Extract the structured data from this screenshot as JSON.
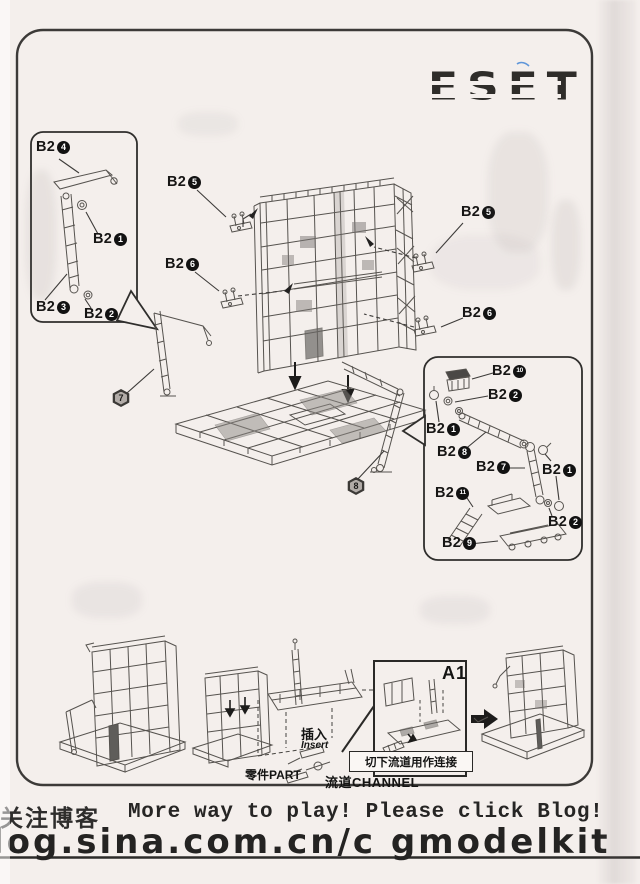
{
  "logo": "ESET",
  "part_labels": [
    {
      "text": "B2",
      "num": "4",
      "x": 36,
      "y": 139
    },
    {
      "text": "B2",
      "num": "1",
      "x": 93,
      "y": 231
    },
    {
      "text": "B2",
      "num": "3",
      "x": 36,
      "y": 299
    },
    {
      "text": "B2",
      "num": "2",
      "x": 84,
      "y": 306
    },
    {
      "text": "B2",
      "num": "5",
      "x": 167,
      "y": 174
    },
    {
      "text": "B2",
      "num": "6",
      "x": 165,
      "y": 256
    },
    {
      "text": "B2",
      "num": "5",
      "x": 461,
      "y": 204
    },
    {
      "text": "B2",
      "num": "6",
      "x": 462,
      "y": 305
    },
    {
      "text": "B2",
      "num": "10",
      "x": 492,
      "y": 363
    },
    {
      "text": "B2",
      "num": "2",
      "x": 488,
      "y": 387
    },
    {
      "text": "B2",
      "num": "1",
      "x": 426,
      "y": 421
    },
    {
      "text": "B2",
      "num": "8",
      "x": 437,
      "y": 444
    },
    {
      "text": "B2",
      "num": "7",
      "x": 476,
      "y": 459
    },
    {
      "text": "B2",
      "num": "1",
      "x": 542,
      "y": 462
    },
    {
      "text": "B2",
      "num": "11",
      "x": 435,
      "y": 485
    },
    {
      "text": "B2",
      "num": "2",
      "x": 548,
      "y": 514
    },
    {
      "text": "B2",
      "num": "9",
      "x": 442,
      "y": 535
    },
    {
      "text": "B1",
      "num": "5",
      "x": 437,
      "y": 751
    }
  ],
  "step_badges": [
    {
      "num": "7",
      "x": 112,
      "y": 389
    },
    {
      "num": "8",
      "x": 347,
      "y": 477
    }
  ],
  "inset": {
    "a1_label": "A1"
  },
  "annotations": {
    "insert_cn": "插入",
    "insert_en": "Insert",
    "part_label": "零件PART",
    "channel_label": "流道CHANNEL",
    "cut_runner_note": "切下流道用作连接"
  },
  "footer": {
    "blog_cn": "关注博客",
    "tagline": "More way to play! Please click Blog!",
    "url": "log.sina.com.cn/c gmodelkit"
  }
}
